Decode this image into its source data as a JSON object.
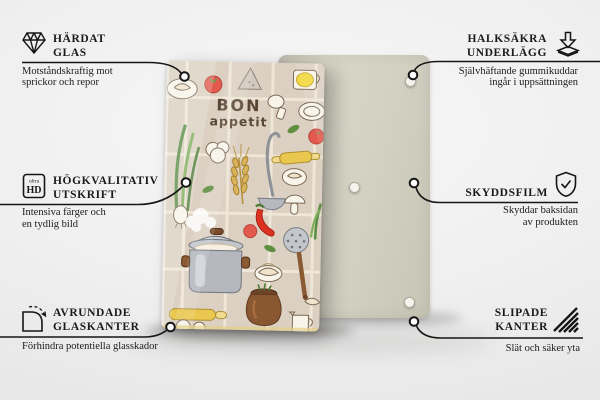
{
  "product": {
    "art_line1": "BON",
    "art_line2": "appetit"
  },
  "callouts": {
    "tempered_glass": {
      "icon": "diamond-icon",
      "title_line1": "HÄRDAT",
      "title_line2": "GLAS",
      "subtitle_line1": "Motståndskraftig mot",
      "subtitle_line2": "sprickor och repor"
    },
    "anti_slip": {
      "icon": "pads-icon",
      "title_line1": "HALKSÄKRA",
      "title_line2": "UNDERLÄGG",
      "subtitle_line1": "Självhäftande gummikuddar",
      "subtitle_line2": "ingår i uppsättningen"
    },
    "print": {
      "icon": "ultra-hd-icon",
      "icon_small": "ultra",
      "icon_large": "HD",
      "title_line1": "HÖGKVALITATIV",
      "title_line2": "UTSKRIFT",
      "subtitle_line1": "Intensiva färger och",
      "subtitle_line2": "en tydlig bild"
    },
    "protective_film": {
      "icon": "shield-check-icon",
      "title_line1": "SKYDDSFILM",
      "subtitle_line1": "Skyddar baksidan",
      "subtitle_line2": "av produkten"
    },
    "rounded_edges": {
      "icon": "rounded-corner-icon",
      "title_line1": "AVRUNDADE",
      "title_line2": "GLASKANTER",
      "subtitle_line1": "Förhindra potentiella glasskador"
    },
    "ground_edges": {
      "icon": "bevel-edge-icon",
      "title_line1": "SLIPADE",
      "title_line2": "KANTER",
      "subtitle_line1": "Slät och säker yta"
    }
  },
  "colors": {
    "background": "#efefef",
    "line": "#161616",
    "front_panel_bg": "#dbd0c1",
    "back_panel_bg": "#d2d0c1",
    "accent_red": "#e2594d",
    "accent_yellow": "#eac74e",
    "accent_green": "#5e8e3e"
  }
}
